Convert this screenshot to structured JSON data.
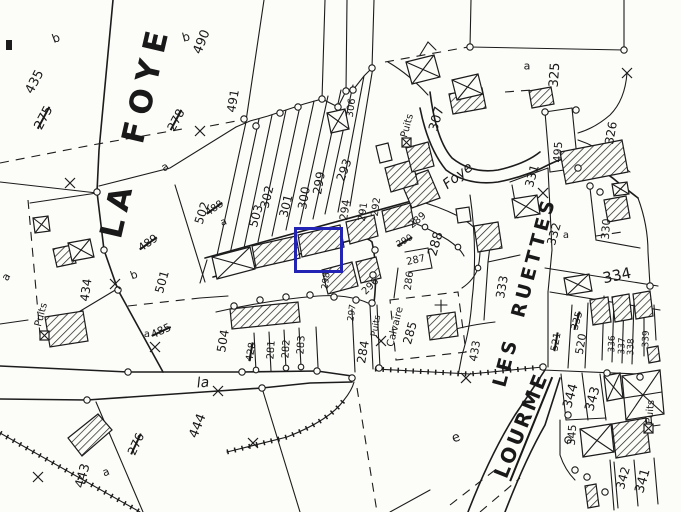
{
  "map": {
    "type": "cadastral-plan-scan",
    "background_color": "#fcfcf9",
    "ink_color": "#1c1c1c",
    "highlight": {
      "color": "#2323b4",
      "x": 294,
      "y": 227,
      "width": 43,
      "height": 40,
      "border": 3
    },
    "place_names": [
      {
        "t": "LA  FOYE",
        "x": 136,
        "y": 131,
        "r": -77,
        "s": 31,
        "sp": 8,
        "b": true
      },
      {
        "t": "LES  RUETTES",
        "x": 525,
        "y": 292,
        "r": -75,
        "s": 19,
        "sp": 4,
        "b": true
      },
      {
        "t": "LOURME",
        "x": 521,
        "y": 425,
        "r": -68,
        "s": 20,
        "sp": 3,
        "b": true,
        "u": true
      }
    ],
    "street_labels": [
      {
        "t": "Foye",
        "x": 458,
        "y": 176,
        "r": -38,
        "s": 14,
        "i": true
      },
      {
        "t": "la",
        "x": 203,
        "y": 383,
        "r": -5,
        "s": 14,
        "i": true
      }
    ],
    "labels": [
      {
        "t": "b",
        "x": 56,
        "y": 38,
        "r": -20,
        "s": 12
      },
      {
        "t": "435",
        "x": 35,
        "y": 82,
        "r": -62,
        "s": 13
      },
      {
        "t": "275",
        "x": 44,
        "y": 118,
        "r": -62,
        "s": 13,
        "st": true
      },
      {
        "t": "b",
        "x": 186,
        "y": 37,
        "r": -15,
        "s": 12
      },
      {
        "t": "490",
        "x": 202,
        "y": 42,
        "r": -68,
        "s": 13
      },
      {
        "t": "278",
        "x": 176,
        "y": 120,
        "r": -62,
        "s": 12,
        "st": true
      },
      {
        "t": "491",
        "x": 233,
        "y": 101,
        "r": -80,
        "s": 12
      },
      {
        "t": "a",
        "x": 165,
        "y": 167,
        "r": -30,
        "s": 11
      },
      {
        "t": "502",
        "x": 202,
        "y": 213,
        "r": -72,
        "s": 12
      },
      {
        "t": "488",
        "x": 215,
        "y": 209,
        "r": -35,
        "s": 10,
        "st": true
      },
      {
        "t": "a",
        "x": 224,
        "y": 223,
        "r": -20,
        "s": 10
      },
      {
        "t": "489",
        "x": 148,
        "y": 243,
        "r": -35,
        "s": 11,
        "st": true
      },
      {
        "t": "503",
        "x": 256,
        "y": 216,
        "r": -74,
        "s": 12
      },
      {
        "t": "302",
        "x": 267,
        "y": 197,
        "r": -76,
        "s": 12
      },
      {
        "t": "301",
        "x": 286,
        "y": 206,
        "r": -76,
        "s": 12
      },
      {
        "t": "300",
        "x": 304,
        "y": 198,
        "r": -80,
        "s": 12
      },
      {
        "t": "299",
        "x": 319,
        "y": 183,
        "r": -80,
        "s": 12
      },
      {
        "t": "293",
        "x": 344,
        "y": 170,
        "r": -70,
        "s": 12
      },
      {
        "t": "294",
        "x": 345,
        "y": 210,
        "r": -82,
        "s": 11
      },
      {
        "t": "291",
        "x": 364,
        "y": 212,
        "r": -82,
        "s": 10
      },
      {
        "t": "292",
        "x": 377,
        "y": 207,
        "r": -82,
        "s": 10
      },
      {
        "t": "306",
        "x": 352,
        "y": 108,
        "r": -82,
        "s": 10
      },
      {
        "t": "307",
        "x": 437,
        "y": 119,
        "r": -74,
        "s": 13
      },
      {
        "t": "Puits",
        "x": 408,
        "y": 126,
        "r": -75,
        "s": 10
      },
      {
        "t": "a",
        "x": 527,
        "y": 66,
        "r": 0,
        "s": 11
      },
      {
        "t": "325",
        "x": 555,
        "y": 75,
        "r": -86,
        "s": 13
      },
      {
        "t": "326",
        "x": 611,
        "y": 133,
        "r": -80,
        "s": 12
      },
      {
        "t": "495",
        "x": 558,
        "y": 152,
        "r": -86,
        "s": 11
      },
      {
        "t": "331",
        "x": 532,
        "y": 176,
        "r": -74,
        "s": 12
      },
      {
        "t": "332",
        "x": 554,
        "y": 234,
        "r": -74,
        "s": 12
      },
      {
        "t": "a",
        "x": 566,
        "y": 236,
        "r": 0,
        "s": 10
      },
      {
        "t": "330",
        "x": 606,
        "y": 229,
        "r": -86,
        "s": 11
      },
      {
        "t": "333",
        "x": 502,
        "y": 287,
        "r": -80,
        "s": 12
      },
      {
        "t": "334",
        "x": 617,
        "y": 276,
        "r": -12,
        "s": 15
      },
      {
        "t": "335",
        "x": 578,
        "y": 321,
        "r": -74,
        "s": 10,
        "st": true
      },
      {
        "t": "521",
        "x": 557,
        "y": 342,
        "r": -80,
        "s": 10,
        "st": true
      },
      {
        "t": "520",
        "x": 581,
        "y": 344,
        "r": -80,
        "s": 11
      },
      {
        "t": "336",
        "x": 613,
        "y": 344,
        "r": -88,
        "s": 9
      },
      {
        "t": "337",
        "x": 623,
        "y": 346,
        "r": -88,
        "s": 9
      },
      {
        "t": "338",
        "x": 632,
        "y": 347,
        "r": -88,
        "s": 9
      },
      {
        "t": "339",
        "x": 647,
        "y": 339,
        "r": -88,
        "s": 9
      },
      {
        "t": "433",
        "x": 475,
        "y": 351,
        "r": -80,
        "s": 11
      },
      {
        "t": "344",
        "x": 571,
        "y": 396,
        "r": -74,
        "s": 13
      },
      {
        "t": "343",
        "x": 593,
        "y": 399,
        "r": -74,
        "s": 13
      },
      {
        "t": "345",
        "x": 572,
        "y": 435,
        "r": -86,
        "s": 11
      },
      {
        "t": "342",
        "x": 623,
        "y": 478,
        "r": -74,
        "s": 12
      },
      {
        "t": "341",
        "x": 643,
        "y": 481,
        "r": -74,
        "s": 13
      },
      {
        "t": "Puits",
        "x": 651,
        "y": 412,
        "r": -85,
        "s": 10
      },
      {
        "t": "e",
        "x": 456,
        "y": 438,
        "r": -20,
        "s": 13
      },
      {
        "t": "444",
        "x": 198,
        "y": 426,
        "r": -68,
        "s": 13
      },
      {
        "t": "276",
        "x": 136,
        "y": 444,
        "r": -65,
        "s": 12,
        "st": true
      },
      {
        "t": "443",
        "x": 83,
        "y": 476,
        "r": -74,
        "s": 13
      },
      {
        "t": "a",
        "x": 106,
        "y": 472,
        "r": -20,
        "s": 11
      },
      {
        "t": "504",
        "x": 223,
        "y": 341,
        "r": -80,
        "s": 12
      },
      {
        "t": "485",
        "x": 161,
        "y": 331,
        "r": -25,
        "s": 11,
        "st": true
      },
      {
        "t": "a",
        "x": 147,
        "y": 335,
        "r": 0,
        "s": 10
      },
      {
        "t": "501",
        "x": 162,
        "y": 282,
        "r": -74,
        "s": 12
      },
      {
        "t": "b",
        "x": 134,
        "y": 275,
        "r": -20,
        "s": 11
      },
      {
        "t": "434",
        "x": 86,
        "y": 290,
        "r": -82,
        "s": 12
      },
      {
        "t": "Puits",
        "x": 42,
        "y": 315,
        "r": -75,
        "s": 10
      },
      {
        "t": "a",
        "x": 6,
        "y": 277,
        "r": -60,
        "s": 11
      },
      {
        "t": "428",
        "x": 252,
        "y": 352,
        "r": -80,
        "s": 10,
        "st": true
      },
      {
        "t": "281",
        "x": 272,
        "y": 350,
        "r": -86,
        "s": 10
      },
      {
        "t": "282",
        "x": 287,
        "y": 349,
        "r": -86,
        "s": 10
      },
      {
        "t": "283",
        "x": 302,
        "y": 345,
        "r": -86,
        "s": 10
      },
      {
        "t": "284",
        "x": 363,
        "y": 352,
        "r": -80,
        "s": 12
      },
      {
        "t": "Puits",
        "x": 377,
        "y": 326,
        "r": -80,
        "s": 9
      },
      {
        "t": "Calvaire",
        "x": 396,
        "y": 327,
        "r": -76,
        "s": 10
      },
      {
        "t": "285",
        "x": 410,
        "y": 333,
        "r": -74,
        "s": 12
      },
      {
        "t": "287",
        "x": 416,
        "y": 261,
        "r": -12,
        "s": 10
      },
      {
        "t": "288",
        "x": 436,
        "y": 244,
        "r": -74,
        "s": 13
      },
      {
        "t": "290",
        "x": 405,
        "y": 242,
        "r": -30,
        "s": 9,
        "st": true
      },
      {
        "t": "289",
        "x": 418,
        "y": 221,
        "r": -40,
        "s": 10
      },
      {
        "t": "286",
        "x": 410,
        "y": 281,
        "r": -82,
        "s": 10
      },
      {
        "t": "296",
        "x": 371,
        "y": 287,
        "r": -45,
        "s": 10
      },
      {
        "t": "297",
        "x": 353,
        "y": 313,
        "r": -82,
        "s": 9
      },
      {
        "t": "298",
        "x": 327,
        "y": 281,
        "r": -82,
        "s": 9
      }
    ]
  }
}
